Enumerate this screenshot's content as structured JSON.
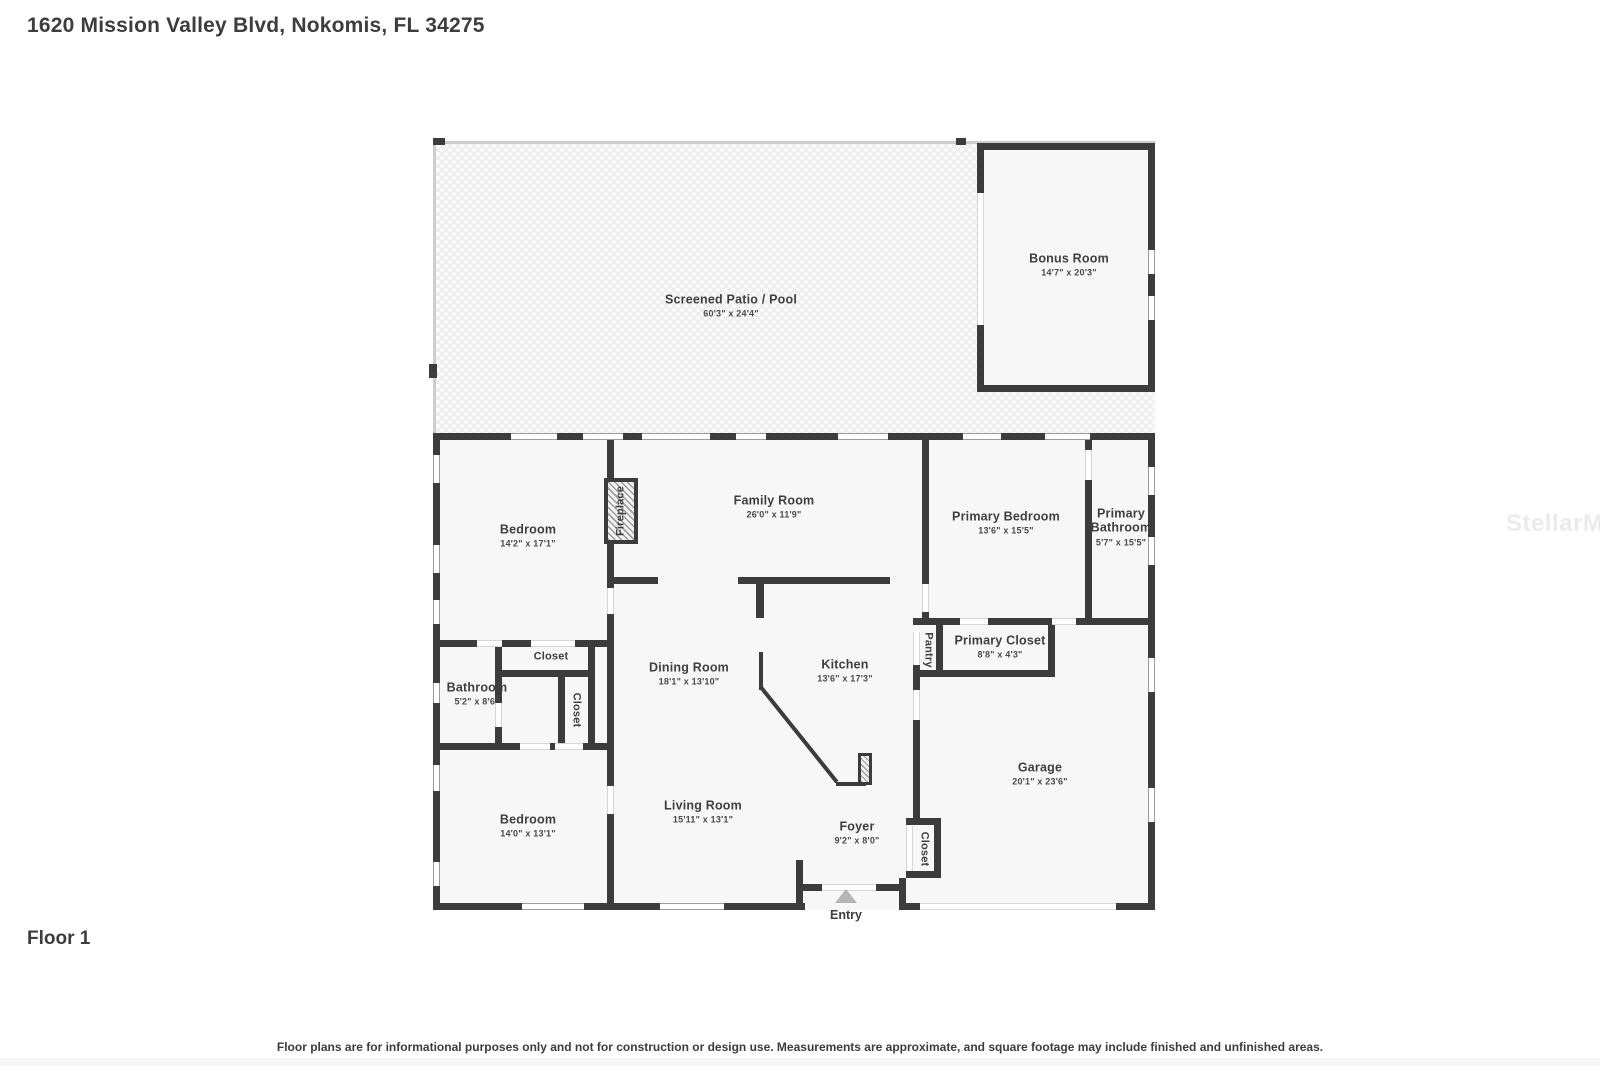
{
  "header": {
    "title": "1620 Mission Valley Blvd, Nokomis, FL 34275"
  },
  "footer": {
    "floor_label": "Floor 1",
    "disclaimer": "Floor plans are for informational purposes only and not for construction or design use. Measurements are approximate, and square footage may include finished and unfinished areas."
  },
  "watermark": "StellarMLS",
  "plan": {
    "entry_label": "Entry",
    "rooms": [
      {
        "id": "patio",
        "name": "Screened Patio / Pool",
        "dims": "60'3\" x 24'4\""
      },
      {
        "id": "bonus",
        "name": "Bonus Room",
        "dims": "14'7\" x 20'3\""
      },
      {
        "id": "bedroom-top",
        "name": "Bedroom",
        "dims": "14'2\" x 17'1\""
      },
      {
        "id": "family-room",
        "name": "Family Room",
        "dims": "26'0\" x 11'9\""
      },
      {
        "id": "primary-bedroom",
        "name": "Primary Bedroom",
        "dims": "13'6\" x 15'5\""
      },
      {
        "id": "primary-bathroom",
        "name": "Primary Bathroom",
        "dims": "5'7\" x 15'5\""
      },
      {
        "id": "closet-hall",
        "name": "Closet",
        "dims": ""
      },
      {
        "id": "bathroom",
        "name": "Bathroom",
        "dims": "5'2\" x 8'6\""
      },
      {
        "id": "closet-vert",
        "name": "Closet",
        "dims": ""
      },
      {
        "id": "dining-room",
        "name": "Dining Room",
        "dims": "18'1\" x 13'10\""
      },
      {
        "id": "kitchen",
        "name": "Kitchen",
        "dims": "13'6\" x 17'3\""
      },
      {
        "id": "pantry",
        "name": "Pantry",
        "dims": ""
      },
      {
        "id": "primary-closet",
        "name": "Primary Closet",
        "dims": "8'8\" x 4'3\""
      },
      {
        "id": "garage",
        "name": "Garage",
        "dims": "20'1\" x 23'6\""
      },
      {
        "id": "living-room",
        "name": "Living Room",
        "dims": "15'11\" x 13'1\""
      },
      {
        "id": "bedroom-bottom",
        "name": "Bedroom",
        "dims": "14'0\" x 13'1\""
      },
      {
        "id": "foyer",
        "name": "Foyer",
        "dims": "9'2\" x 8'0\""
      },
      {
        "id": "fireplace",
        "name": "Fireplace",
        "dims": ""
      },
      {
        "id": "closet-foyer",
        "name": "Closet",
        "dims": ""
      }
    ]
  },
  "colors": {
    "wall": "#3c3c3c",
    "text": "#3f3f3f",
    "room_fill": "#f7f7f7",
    "patio_fill": "#efefef",
    "watermark": "#ebebeb",
    "entry_marker": "#b5b5b5"
  }
}
